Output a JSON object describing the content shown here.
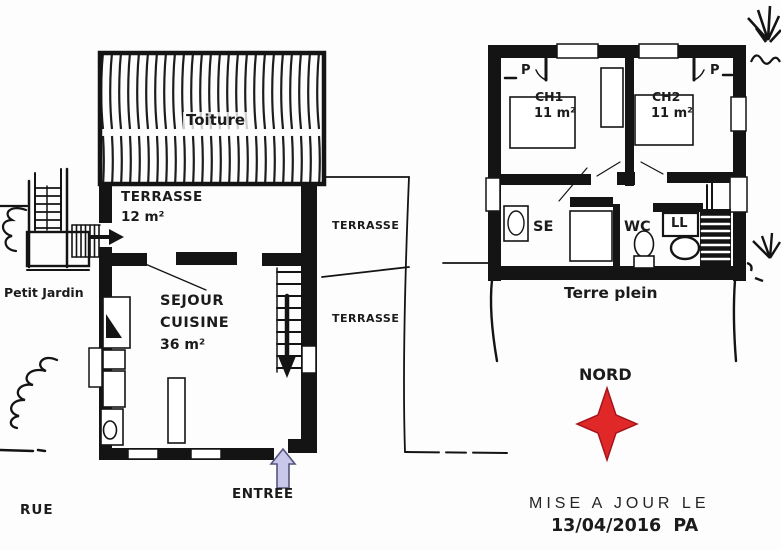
{
  "colors": {
    "ink": "#1a1a1a",
    "star_red": "#e02828",
    "entry_arrow_fill": "#c9c8ea",
    "entry_arrow_stroke": "#55557d"
  },
  "ground_floor": {
    "roof_label": "Toiture",
    "main_terrace_label": "TERRASSE",
    "main_terrace_area": "12 m²",
    "living_label_line1": "SEJOUR",
    "living_label_line2": "CUISINE",
    "living_area": "36 m²",
    "side_terrace_top_label": "TERRASSE",
    "side_terrace_bottom_label": "TERRASSE",
    "garden_label": "Petit Jardin",
    "street_label": "RUE",
    "entrance_label": "ENTREE"
  },
  "upper_floor": {
    "closet_left_label": "P",
    "closet_right_label": "P",
    "bedroom1_label": "CH1",
    "bedroom1_area": "11 m²",
    "bedroom2_label": "CH2",
    "bedroom2_area": "11 m²",
    "shower_room_label": "SE",
    "wc_label": "WC",
    "laundry_label": "LL",
    "ground_label": "Terre plein"
  },
  "compass": {
    "north_label": "NORD"
  },
  "footer": {
    "updated_label": "MISE A JOUR LE",
    "updated_date": "13/04/2016  PA"
  }
}
